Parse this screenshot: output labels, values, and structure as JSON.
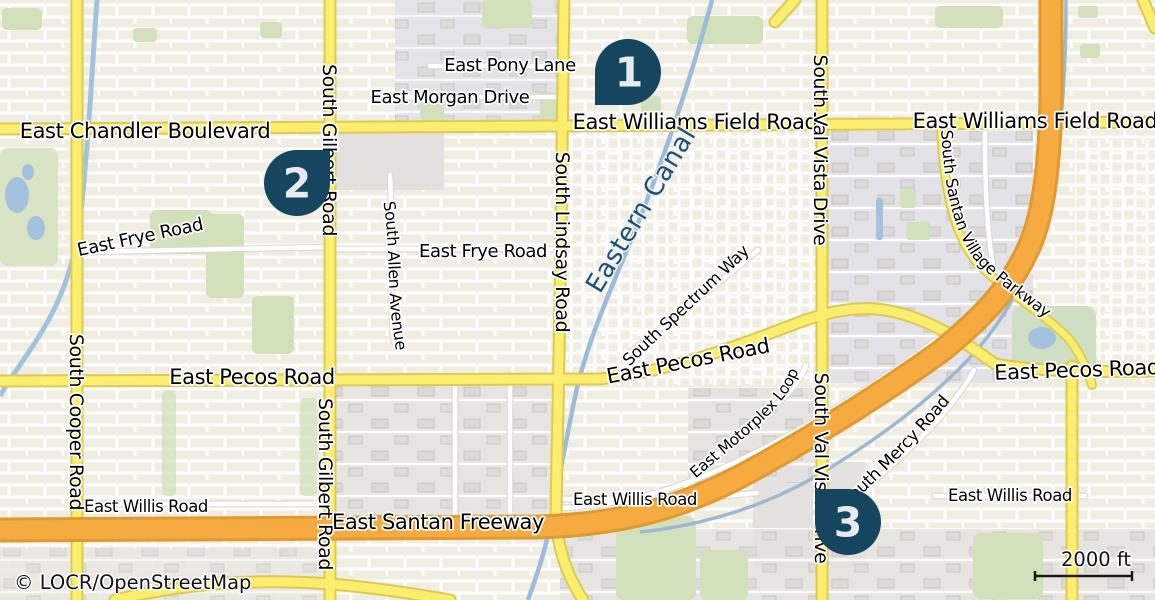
{
  "map": {
    "attribution": "© LOCR/OpenStreetMap",
    "scale_label": "2000 ft",
    "markers": {
      "m1": "1",
      "m2": "2",
      "m3": "3"
    },
    "labels": {
      "chandler": "East Chandler Boulevard",
      "williams_center": "East Williams Field Road",
      "williams_east": "East Williams Field Road",
      "pony": "East Pony Lane",
      "morgan": "East Morgan Drive",
      "frye_west": "East Frye Road",
      "frye_east": "East Frye Road",
      "pecos_west": "East Pecos Road",
      "pecos_center": "East Pecos Road",
      "pecos_east": "East Pecos Road",
      "willis_west": "East Willis Road",
      "willis_center": "East Willis Road",
      "willis_east": "East Willis Road",
      "santan_freeway": "East Santan Freeway",
      "cooper": "South Cooper Road",
      "gilbert_north": "South Gilbert Road",
      "gilbert_south": "South Gilbert Road",
      "lindsay": "South Lindsay Road",
      "val_vista_north": "South Val Vista Drive",
      "val_vista_south": "South Val Vista Drive",
      "eastern_canal": "Eastern Canal",
      "santan_village_parkway": "South Santan Village Parkway",
      "allen": "South Allen Avenue",
      "spectrum": "South Spectrum Way",
      "motorplex": "East Motorplex Loop",
      "mercy": "South Mercy Road"
    },
    "colors": {
      "land": "#f0ede3",
      "urban": "#e4e3e6",
      "park": "#d2e0bc",
      "water": "#a3c2de",
      "road_yellow": "#fbee6e",
      "road_yellow_casing": "#ddca52",
      "freeway": "#f6ab40",
      "freeway_casing": "#df9a31",
      "minor_road": "#ffffff",
      "canal_label": "#1e5077",
      "marker_fill": "#16465f",
      "marker_text": "#e7ebed"
    }
  }
}
